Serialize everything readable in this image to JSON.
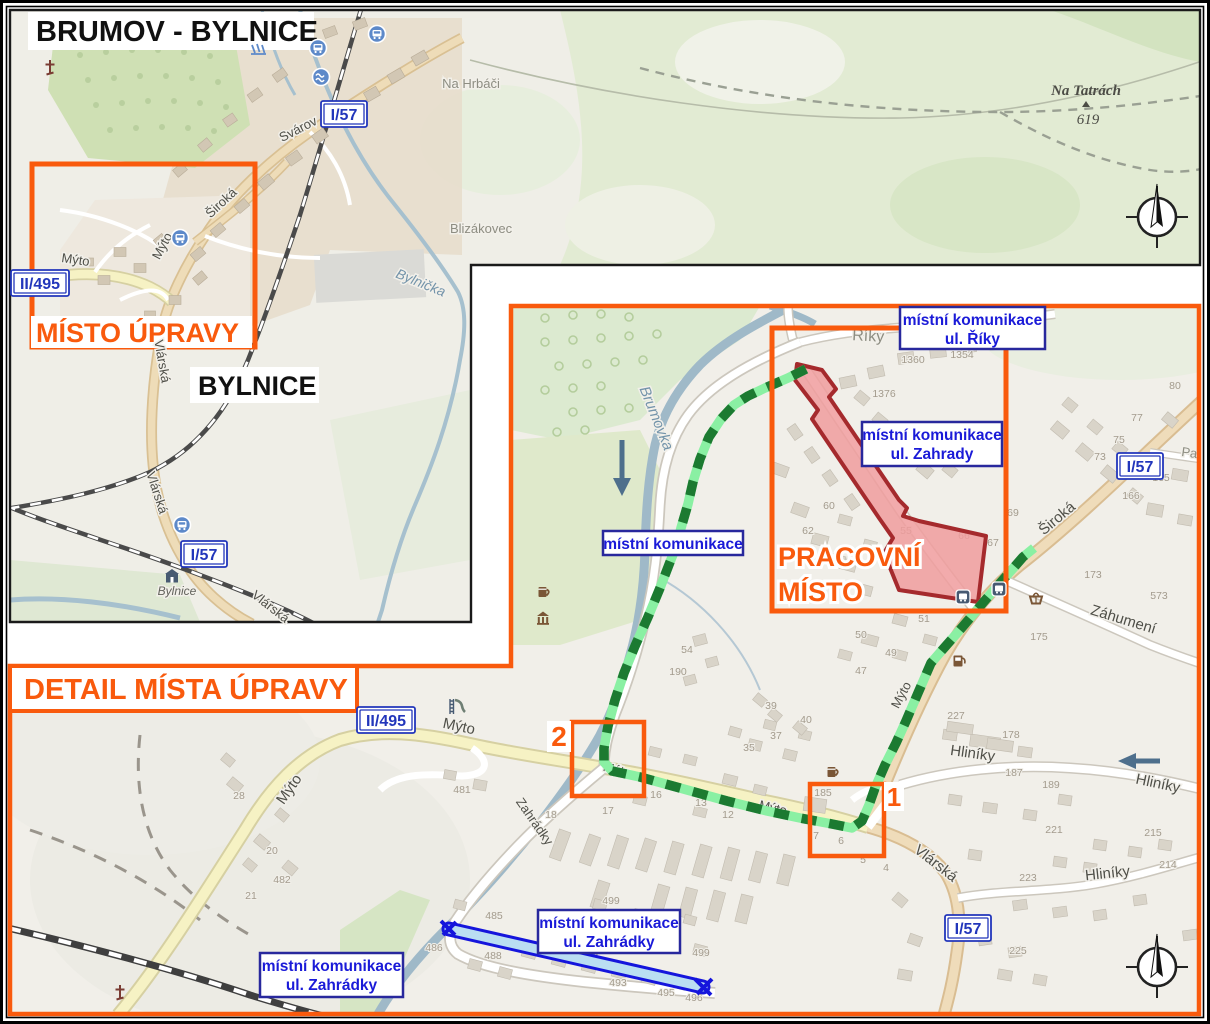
{
  "colors": {
    "accent_orange": "#f95a0d",
    "callout_text_blue": "#1a1ad8",
    "callout_border_blue": "#28289d",
    "badge_blue": "#2236bb",
    "route_dark_green": "#1c7a31",
    "route_light_green": "#8af0a3",
    "work_zone_fill": "#f09c9d",
    "work_zone_stroke": "#a52a2d",
    "closed_road_fill": "#badef2",
    "closed_road_stroke": "#1515dc"
  },
  "overview": {
    "title": "BRUMOV - BYLNICE",
    "district_label": "BYLNICE",
    "site_box_label": "MÍSTO ÚPRAVY",
    "peak": {
      "name": "Na Tatrách",
      "elevation": "619"
    },
    "badges": [
      {
        "t": "I/57",
        "x": 344,
        "y": 114
      },
      {
        "t": "II/495",
        "x": 40,
        "y": 283
      },
      {
        "t": "I/57",
        "x": 204,
        "y": 554
      }
    ],
    "labels": [
      {
        "t": "Svárov",
        "x": 300,
        "y": 133,
        "r": -27,
        "k": "road"
      },
      {
        "t": "Široká",
        "x": 224,
        "y": 206,
        "r": -43,
        "k": "road"
      },
      {
        "t": "Mýto",
        "x": 75,
        "y": 264,
        "r": 8,
        "k": "road"
      },
      {
        "t": "Mýto",
        "x": 166,
        "y": 248,
        "r": -62,
        "k": "road"
      },
      {
        "t": "Vlárská",
        "x": 158,
        "y": 362,
        "r": 80,
        "k": "road"
      },
      {
        "t": "Vlárská",
        "x": 153,
        "y": 494,
        "r": 72,
        "k": "road"
      },
      {
        "t": "Vlárská",
        "x": 268,
        "y": 610,
        "r": 38,
        "k": "road"
      },
      {
        "t": "Na Hrbáči",
        "x": 471,
        "y": 88,
        "r": 0,
        "k": "place"
      },
      {
        "t": "Blizákovec",
        "x": 481,
        "y": 233,
        "r": 0,
        "k": "place"
      },
      {
        "t": "Bylnička",
        "x": 419,
        "y": 287,
        "r": 22,
        "k": "water"
      },
      {
        "t": "Bylnice",
        "x": 177,
        "y": 595,
        "r": 0,
        "k": "station"
      }
    ],
    "icons": [
      [
        "train-station",
        318,
        48
      ],
      [
        "train-station",
        377,
        34
      ],
      [
        "swimming",
        321,
        77
      ],
      [
        "weir",
        258,
        49
      ],
      [
        "train-station",
        180,
        238
      ],
      [
        "train-station",
        182,
        525
      ],
      [
        "station",
        172,
        578
      ],
      [
        "church",
        50,
        68
      ]
    ]
  },
  "detail": {
    "heading": "DETAIL MÍSTA ÚPRAVY",
    "work_zone": {
      "line1": "PRACOVNÍ",
      "line2": "MÍSTO"
    },
    "markers": [
      {
        "n": "1"
      },
      {
        "n": "2"
      }
    ],
    "badges": [
      {
        "t": "II/495",
        "x": 386,
        "y": 720
      },
      {
        "t": "I/57",
        "x": 1140,
        "y": 466
      },
      {
        "t": "I/57",
        "x": 968,
        "y": 928
      }
    ],
    "callouts": [
      {
        "x": 900,
        "y": 307,
        "w": 145,
        "h": 42,
        "lines": [
          "místní komunikace",
          "ul. Říky"
        ]
      },
      {
        "x": 862,
        "y": 422,
        "w": 140,
        "h": 44,
        "lines": [
          "místní komunikace",
          "ul. Zahrady"
        ]
      },
      {
        "x": 603,
        "y": 531,
        "w": 140,
        "h": 24,
        "lines": [
          "místní komunikace"
        ]
      },
      {
        "x": 538,
        "y": 910,
        "w": 142,
        "h": 43,
        "lines": [
          "místní komunikace",
          "ul. Zahrádky"
        ]
      },
      {
        "x": 260,
        "y": 953,
        "w": 143,
        "h": 44,
        "lines": [
          "místní komunikace",
          "ul. Zahrádky"
        ]
      }
    ],
    "labels": [
      {
        "t": "Říky",
        "x": 868,
        "y": 341,
        "r": 3,
        "k": "place",
        "s": 16
      },
      {
        "t": "Brumovka",
        "x": 652,
        "y": 420,
        "r": 68,
        "k": "water",
        "s": 15
      },
      {
        "t": "Mýto",
        "x": 458,
        "y": 731,
        "r": 12,
        "k": "road",
        "s": 15
      },
      {
        "t": "Mýto",
        "x": 293,
        "y": 792,
        "r": -55,
        "k": "road",
        "s": 15
      },
      {
        "t": "Mýto",
        "x": 616,
        "y": 774,
        "r": 14,
        "k": "road"
      },
      {
        "t": "Mýto",
        "x": 772,
        "y": 812,
        "r": 13,
        "k": "road"
      },
      {
        "t": "Mýto",
        "x": 905,
        "y": 697,
        "r": -62,
        "k": "road"
      },
      {
        "t": "Široká",
        "x": 1060,
        "y": 522,
        "r": -40,
        "k": "road",
        "s": 15
      },
      {
        "t": "Pann",
        "x": 1196,
        "y": 458,
        "r": 8,
        "k": "place"
      },
      {
        "t": "Záhumení",
        "x": 1122,
        "y": 624,
        "r": 17,
        "k": "road",
        "s": 15
      },
      {
        "t": "Hliníky",
        "x": 972,
        "y": 758,
        "r": 8,
        "k": "road",
        "s": 15
      },
      {
        "t": "Hliníky",
        "x": 1157,
        "y": 788,
        "r": 12,
        "k": "road",
        "s": 15
      },
      {
        "t": "Hliníky",
        "x": 1108,
        "y": 878,
        "r": -6,
        "k": "road",
        "s": 15
      },
      {
        "t": "Vlárská",
        "x": 933,
        "y": 867,
        "r": 38,
        "k": "road",
        "s": 15
      },
      {
        "t": "Zahrádky",
        "x": 531,
        "y": 824,
        "r": 55,
        "k": "road"
      },
      {
        "t": "Zahrádky",
        "x": 580,
        "y": 960,
        "r": 11,
        "k": "place"
      }
    ],
    "house_numbers": [
      [
        "1376",
        884,
        397
      ],
      [
        "1360",
        913,
        363
      ],
      [
        "1354",
        962,
        358
      ],
      [
        "80",
        1175,
        389
      ],
      [
        "77",
        1137,
        421
      ],
      [
        "75",
        1119,
        443
      ],
      [
        "73",
        1100,
        460
      ],
      [
        "69",
        1013,
        516
      ],
      [
        "165",
        1161,
        481
      ],
      [
        "166",
        1131,
        499
      ],
      [
        "60",
        829,
        509
      ],
      [
        "62",
        808,
        534
      ],
      [
        "55",
        906,
        534
      ],
      [
        "66",
        964,
        539
      ],
      [
        "67",
        993,
        546
      ],
      [
        "51",
        924,
        622
      ],
      [
        "50",
        861,
        638
      ],
      [
        "49",
        891,
        656
      ],
      [
        "47",
        861,
        674
      ],
      [
        "175",
        1039,
        640
      ],
      [
        "173",
        1093,
        578
      ],
      [
        "573",
        1159,
        599
      ],
      [
        "54",
        687,
        653
      ],
      [
        "190",
        678,
        675
      ],
      [
        "39",
        771,
        709
      ],
      [
        "40",
        806,
        723
      ],
      [
        "37",
        776,
        739
      ],
      [
        "35",
        749,
        751
      ],
      [
        "16",
        656,
        798
      ],
      [
        "13",
        701,
        806
      ],
      [
        "12",
        728,
        818
      ],
      [
        "17",
        608,
        814
      ],
      [
        "18",
        551,
        818
      ],
      [
        "185",
        823,
        796
      ],
      [
        "7",
        816,
        839
      ],
      [
        "6",
        841,
        844
      ],
      [
        "5",
        863,
        863
      ],
      [
        "4",
        886,
        871
      ],
      [
        "227",
        956,
        719
      ],
      [
        "178",
        1011,
        738
      ],
      [
        "187",
        1014,
        776
      ],
      [
        "189",
        1051,
        788
      ],
      [
        "221",
        1054,
        833
      ],
      [
        "215",
        1153,
        836
      ],
      [
        "214",
        1168,
        868
      ],
      [
        "223",
        1028,
        881
      ],
      [
        "225",
        1018,
        954
      ],
      [
        "485",
        494,
        919
      ],
      [
        "486",
        434,
        951
      ],
      [
        "488",
        493,
        959
      ],
      [
        "493",
        618,
        986
      ],
      [
        "495",
        666,
        996
      ],
      [
        "496",
        694,
        1001
      ],
      [
        "499",
        611,
        904
      ],
      [
        "499",
        701,
        956
      ],
      [
        "28",
        239,
        799
      ],
      [
        "20",
        272,
        854
      ],
      [
        "482",
        282,
        883
      ],
      [
        "21",
        251,
        899
      ],
      [
        "481",
        462,
        793
      ]
    ],
    "icons": [
      [
        "bus-stop",
        963,
        597
      ],
      [
        "bus-stop",
        999,
        589
      ],
      [
        "basket",
        1036,
        599
      ],
      [
        "fuel",
        958,
        661
      ],
      [
        "pub",
        832,
        772
      ],
      [
        "pub",
        543,
        592
      ],
      [
        "museum",
        543,
        618
      ],
      [
        "playground",
        456,
        706
      ],
      [
        "church",
        120,
        993
      ]
    ]
  }
}
